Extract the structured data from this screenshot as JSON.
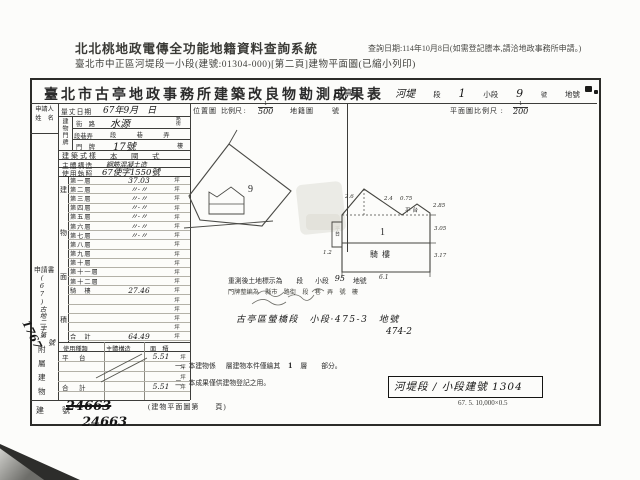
{
  "header": {
    "system_name": "北北桃地政電傳全功能地籍資料查詢系統",
    "query_date": "查詢日期:114年10月8日(如需登記謄本,請洽地政事務所申請。)",
    "subtitle": "臺北市中正區河堤段一小段(建號:01304-000)[第二頁]建物平面圖(已縮小列印)"
  },
  "form": {
    "title": "臺北市古亭地政事務所建築改良物勘測成果表",
    "location_line": {
      "v1": "古亭",
      "l1": "區",
      "v2": "河堤",
      "l2": "段",
      "v3": "1",
      "l3": "小段",
      "v4": "9",
      "l4": "號",
      "l5": "地號"
    },
    "applicant_label_1": "申請人",
    "applicant_label_2": "姓　名",
    "survey_date_label": "量丈日期",
    "survey_date_value": "67年9月　日",
    "location_map": {
      "label": "位置圖",
      "scale_label": "比例尺 :",
      "scale_num": "1",
      "scale_den": "500",
      "cadastral_label": "地籍圖",
      "cadastral_suffix": "號",
      "parcel_no": "9"
    },
    "plan_scale": {
      "label": "平面圖比例尺 :",
      "num": "1",
      "den": "200"
    },
    "address": {
      "label": "建物門牌",
      "street_label": "街　路",
      "street_value": "水源",
      "street_suffix_1": "路",
      "street_suffix_2": "街",
      "lane_label": "段巷弄",
      "lane_value": "段　巷　弄",
      "no_label": "門　牌",
      "no_value": "17號",
      "no_suffix": "樓"
    },
    "style_label": "建築式樣",
    "style_value": "本　國　式",
    "structure_label": "主體構造",
    "structure_value": "鋼筋混凝土造",
    "license_label": "使用執照",
    "license_value": "67使字1550號",
    "area_col_label_1": "建",
    "area_col_label_2": "物",
    "area_col_label_3": "面",
    "area_col_label_4": "積",
    "floors": [
      {
        "label": "第一層",
        "value": "37.03",
        "unit": "坪"
      },
      {
        "label": "第二層",
        "value": "〃·〃",
        "unit": "坪"
      },
      {
        "label": "第三層",
        "value": "〃·〃",
        "unit": "坪"
      },
      {
        "label": "第四層",
        "value": "〃·〃",
        "unit": "坪"
      },
      {
        "label": "第五層",
        "value": "〃·〃",
        "unit": "坪"
      },
      {
        "label": "第六層",
        "value": "〃·〃",
        "unit": "坪"
      },
      {
        "label": "第七層",
        "value": "〃·〃",
        "unit": "坪"
      },
      {
        "label": "第八層",
        "value": "",
        "unit": "坪"
      },
      {
        "label": "第九層",
        "value": "",
        "unit": "坪"
      },
      {
        "label": "第十層",
        "value": "",
        "unit": "坪"
      },
      {
        "label": "第十一層",
        "value": "",
        "unit": "坪"
      },
      {
        "label": "第十二層",
        "value": "",
        "unit": "坪"
      },
      {
        "label": "騎　樓",
        "value": "27.46",
        "unit": "坪"
      },
      {
        "label": "",
        "value": "",
        "unit": "坪"
      },
      {
        "label": "",
        "value": "",
        "unit": "坪"
      },
      {
        "label": "",
        "value": "",
        "unit": "坪"
      },
      {
        "label": "",
        "value": "",
        "unit": "坪"
      },
      {
        "label": "合　計",
        "value": "64.49",
        "unit": "坪"
      }
    ],
    "attachment": {
      "side_label_1": "附",
      "side_label_2": "屬",
      "side_label_3": "建",
      "side_label_4": "物",
      "col_use": "使用種類",
      "col_structure": "主體構造",
      "col_area": "面　積",
      "rows": [
        {
          "use": "平　台",
          "structure": "",
          "area": "5.51",
          "unit": "坪"
        },
        {
          "use": "",
          "structure": "",
          "area": "",
          "unit": "坪"
        },
        {
          "use": "",
          "structure": "",
          "area": "",
          "unit": "坪"
        },
        {
          "use": "合　計",
          "structure": "",
          "area": "5.51",
          "unit": "坪"
        }
      ]
    },
    "building_no": {
      "label": "建　號",
      "struck": "24663",
      "value": "24663"
    },
    "application": {
      "label": "申請書",
      "number_prefix": "(67)古地二字第",
      "number": "1767",
      "suffix": "號"
    },
    "floor_plan": {
      "unit_no": "1",
      "arcade": "騎樓",
      "platform": "平台",
      "dims": {
        "top_left": "2.6",
        "top_right": "2.4",
        "plat_top": "0.75",
        "plat_right": "2.85",
        "right_upper": "3.05",
        "right_lower": "3.17",
        "bottom": "6.1",
        "left": "1.2"
      }
    },
    "resurvey": {
      "prefix": "重測後土地標示為",
      "seg": "段",
      "subseg": "小段",
      "hand_no": "95",
      "suffix": "地號",
      "line2": "門牌整編為　縣市　路街　段　巷　弄　號　樓",
      "hand_line": "古亭區螢橋段　小段·475-3　地號",
      "hand_line2": "474-2"
    },
    "notes": {
      "n1a": "一、本建物係",
      "n1b": "層建物本件僅繪其",
      "n1c": "1",
      "n1d": "層",
      "n1e": "部分。",
      "n2": "二、本成果僅供建物登記之用。",
      "page": "(建物平面圖第　　頁)"
    },
    "registry_box": "河堤段 / 小段建號 1304",
    "print_code": "67. 5. 10,000×0.5"
  }
}
